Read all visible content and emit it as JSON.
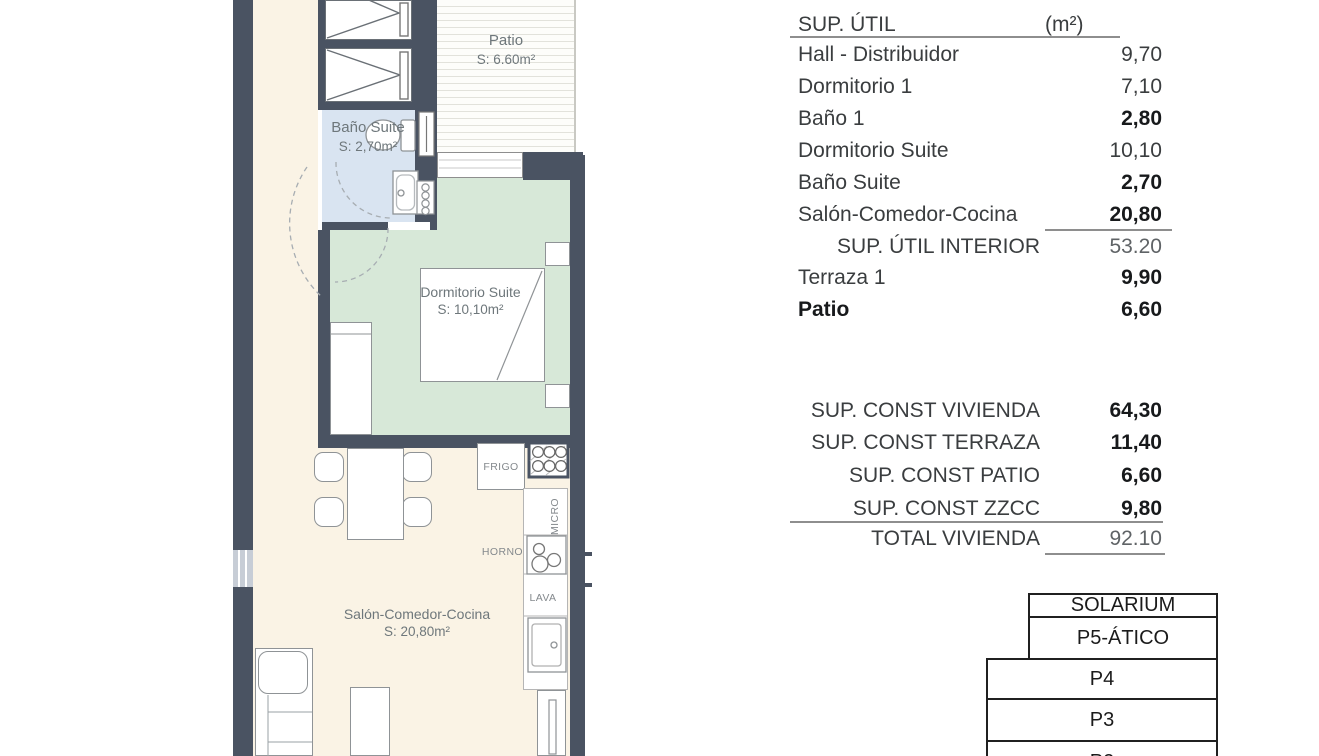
{
  "plan": {
    "rooms": {
      "patio": {
        "name": "Patio",
        "area": "S: 6.60m²"
      },
      "bano_suite": {
        "name": "Baño Suite",
        "area": "S: 2,70m²"
      },
      "dormitorio_suite": {
        "name": "Dormitorio Suite",
        "area": "S: 10,10m²"
      },
      "salon": {
        "name": "Salón-Comedor-Cocina",
        "area": "S: 20,80m²"
      }
    },
    "appliances": {
      "frigo": "FRIGO",
      "micro": "MICRO",
      "horno": "HORNO",
      "lava": "LAVA"
    }
  },
  "sup_util": {
    "title": "SUP. ÚTIL",
    "unit": "(m²)",
    "rows": [
      {
        "label": "Hall - Distribuidor",
        "value": "9,70"
      },
      {
        "label": "Dormitorio 1",
        "value": "7,10"
      },
      {
        "label": "Baño 1",
        "value": "2,80"
      },
      {
        "label": "Dormitorio Suite",
        "value": "10,10"
      },
      {
        "label": "Baño Suite",
        "value": "2,70"
      },
      {
        "label": "Salón-Comedor-Cocina",
        "value": "20,80"
      }
    ],
    "subtotal": {
      "label": "SUP. ÚTIL INTERIOR",
      "value": "53.20"
    },
    "extra": [
      {
        "label": "Terraza 1",
        "value": "9,90"
      },
      {
        "label": "Patio",
        "value": "6,60"
      }
    ]
  },
  "sup_const": {
    "rows": [
      {
        "label": "SUP. CONST VIVIENDA",
        "value": "64,30"
      },
      {
        "label": "SUP. CONST TERRAZA",
        "value": "11,40"
      },
      {
        "label": "SUP. CONST PATIO",
        "value": "6,60"
      },
      {
        "label": "SUP. CONST ZZCC",
        "value": "9,80"
      }
    ],
    "total": {
      "label": "TOTAL VIVIENDA",
      "value": "92.10"
    }
  },
  "floors": [
    "SOLARIUM",
    "P5-ÁTICO",
    "P4",
    "P3",
    "P2"
  ],
  "colors": {
    "wall": "#4a5362",
    "floor_cream": "#faf3e5",
    "bedroom_green": "#d7e8d8",
    "bath_blue": "#d9e4f1",
    "patio_white": "#fdfdfa",
    "furniture_line": "#8f9396",
    "plan_text": "#6e777b",
    "table_text": "#3a3d3f"
  }
}
